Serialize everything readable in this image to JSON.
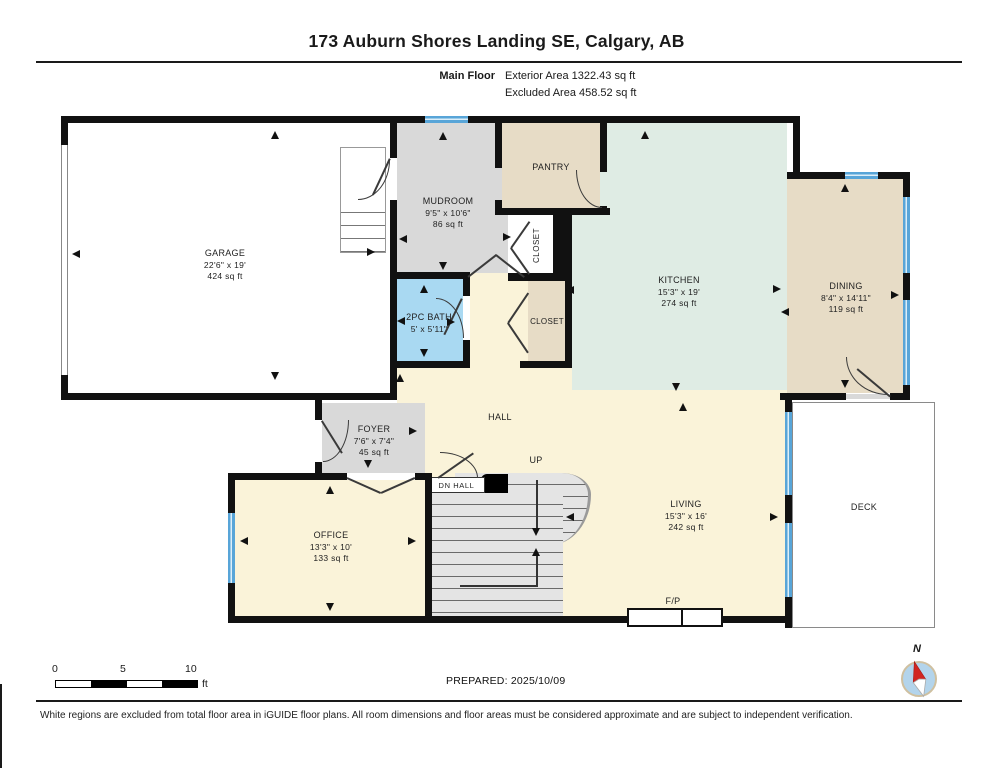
{
  "header": {
    "title": "173 Auburn Shores Landing SE, Calgary, AB",
    "floor_label": "Main Floor",
    "area_line1": "Exterior Area 1322.43 sq ft",
    "area_line2": "Excluded Area 458.52 sq ft"
  },
  "rooms": {
    "garage": {
      "name": "GARAGE",
      "dims": "22'6\" x 19'",
      "area": "424 sq ft"
    },
    "mudroom": {
      "name": "MUDROOM",
      "dims": "9'5\" x 10'6\"",
      "area": "86 sq ft"
    },
    "pantry": {
      "name": "PANTRY"
    },
    "closet_upper": {
      "name": "CLOSET"
    },
    "closet_lower": {
      "name": "CLOSET"
    },
    "kitchen": {
      "name": "KITCHEN",
      "dims": "15'3\" x 19'",
      "area": "274 sq ft"
    },
    "dining": {
      "name": "DINING",
      "dims": "8'4\" x 14'11\"",
      "area": "119 sq ft"
    },
    "bath": {
      "name": "2PC BATH",
      "dims": "5' x 5'11\""
    },
    "foyer": {
      "name": "FOYER",
      "dims": "7'6\" x 7'4\"",
      "area": "45 sq ft"
    },
    "hall": {
      "name": "HALL"
    },
    "dn_hall": {
      "name": "DN  HALL"
    },
    "up": {
      "name": "UP"
    },
    "office": {
      "name": "OFFICE",
      "dims": "13'3\" x 10'",
      "area": "133 sq ft"
    },
    "living": {
      "name": "LIVING",
      "dims": "15'3\" x 16'",
      "area": "242 sq ft"
    },
    "deck": {
      "name": "DECK"
    },
    "fireplace": {
      "name": "F/P"
    }
  },
  "scale_bar": {
    "tick0": "0",
    "tick5": "5",
    "tick10": "10",
    "unit": "ft"
  },
  "compass": {
    "north": "N"
  },
  "footer": {
    "prepared": "PREPARED: 2025/10/09",
    "disclaimer": "White regions are excluded from total floor area in iGUIDE floor plans. All room dimensions and floor areas must be considered approximate and are subject to independent verification."
  },
  "colors": {
    "wall": "#111111",
    "cream": "#faf3d9",
    "gray": "#d9d9d9",
    "tan": "#e7dcc6",
    "mint": "#dfece4",
    "bathblue": "#a9d9f2",
    "winblue": "#58a5d8",
    "stair": "#e4e4e4",
    "red": "#d12520",
    "line": "#3a3a3a"
  }
}
